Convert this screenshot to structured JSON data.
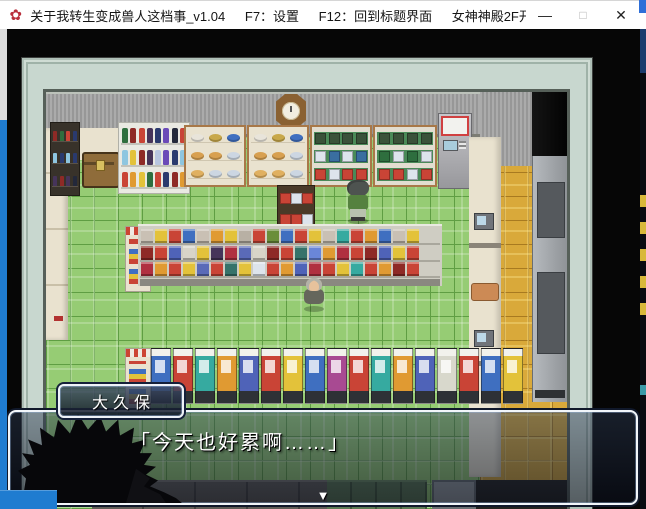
{
  "titlebar": {
    "app_icon": "✿",
    "segments": [
      "关于我转生变成兽人这档事_v1.04",
      "F7：设置",
      "F12：回到标题界面",
      "女神神殿2F开永久..."
    ],
    "controls": {
      "minimize": "—",
      "maximize": "□",
      "close": "✕"
    }
  },
  "dialogue": {
    "speaker": "大久保",
    "text": "「今天也好累啊……」",
    "continue_indicator": "▼"
  },
  "theme": {
    "floor": "#96cc74",
    "floorline": "#5f9e43",
    "corridor": "#d9a93a",
    "corridorline": "#a87a20",
    "wall": "#a2a2a2",
    "frame": "#c8d7cf",
    "cream": "#e9e2cf",
    "wood": "#a87848",
    "taskbar": "#1f7cd0",
    "dialogborder": "#f2f6fa"
  },
  "map": {
    "characters": [
      {
        "name": "clerk",
        "hair": "#4e5350",
        "shirt": "#55813f",
        "pants": "#b9c2ae"
      },
      {
        "name": "elder",
        "head": "#e7c29c",
        "hair": "#b2b2a8",
        "coat": "#65665c"
      }
    ],
    "generated": {
      "vending": {
        "cls": "vm",
        "colors": [
          "#3f6fc0",
          "#c94436",
          "#36aaa0",
          "#e09a32",
          "#4f63b8",
          "#c94436",
          "#e3c23a",
          "#3f6fc0",
          "#a84a92",
          "#c94436",
          "#36aaa0",
          "#e09a32",
          "#4f63b8",
          "#d8d8cc",
          "#c94436",
          "#3f6fc0",
          "#e3c23a"
        ]
      },
      "aisle_top": {
        "cls": "itm",
        "colors": [
          "#c9c0b4",
          "#e3c23a",
          "#c94436",
          "#3f6fc0",
          "#c9c0b4",
          "#e09a32",
          "#e3c23a",
          "#b8b0a4",
          "#c94436",
          "#6a8e3a",
          "#3f6fc0",
          "#c94436",
          "#e3c23a",
          "#c9c0b4",
          "#36aaa0",
          "#c94436",
          "#e09a32",
          "#3f6fc0",
          "#c9c0b4",
          "#e3c23a"
        ]
      },
      "aisle_mid": {
        "cls": "itm",
        "colors": [
          "#8e2a26",
          "#c94436",
          "#4f63b8",
          "#d8d4c8",
          "#e3c23a",
          "#46345a",
          "#b03040",
          "#5a6ab8",
          "#d8d4c8",
          "#8e2a26",
          "#c94436",
          "#36736a",
          "#6a86d8",
          "#e09a32",
          "#b03040",
          "#c94436",
          "#8e2a26",
          "#4f63b8",
          "#e3c23a",
          "#c94436"
        ]
      },
      "aisle_low": {
        "cls": "itm",
        "colors": [
          "#b03040",
          "#e09a32",
          "#c94436",
          "#e3c23a",
          "#5a6ab8",
          "#c94436",
          "#36736a",
          "#e3c23a",
          "#dde4ec",
          "#c94436",
          "#e09a32",
          "#4f63b8",
          "#b03040",
          "#c94436",
          "#e3c23a",
          "#36aaa0",
          "#c94436",
          "#e09a32",
          "#8e2a26",
          "#c94436"
        ]
      },
      "bottles_r1": {
        "cls": "bottle",
        "colors": [
          "#2e6e3e",
          "#8e2a26",
          "#c94436",
          "#46345a",
          "#2a3a6e",
          "#6a4ab8",
          "#23283a",
          "#c94436"
        ]
      },
      "bottles_r2": {
        "cls": "bottle",
        "colors": [
          "#8ec6e0",
          "#e3c23a",
          "#8e2a26",
          "#46345a",
          "#b8c6e0",
          "#6a4ab8",
          "#2a3a6e",
          "#8ec6e0"
        ]
      },
      "bottles_r3": {
        "cls": "bottle",
        "colors": [
          "#c94436",
          "#e09a32",
          "#e3c23a",
          "#2e6e3e",
          "#c94436",
          "#2a3a6e",
          "#8e2a26",
          "#e09a32"
        ]
      },
      "left_r1": {
        "cls": "minib",
        "colors": [
          "#8e2a26",
          "#2e6e3e",
          "#c94436",
          "#2a3a6e"
        ]
      },
      "left_r2": {
        "cls": "minib",
        "colors": [
          "#8ec6e0",
          "#2a3a6e",
          "#8ec6e0",
          "#2a3a6e"
        ]
      },
      "left_r3": {
        "cls": "minib",
        "colors": [
          "#46345a",
          "#8e2a26",
          "#46345a",
          "#23283a"
        ]
      },
      "counterA_r1": {
        "cls": "food",
        "colors": [
          "#e8e4da",
          "#c8a84a",
          "#3f6fc0"
        ]
      },
      "counterA_r2": {
        "cls": "food",
        "colors": [
          "#d8a050",
          "#d8a050",
          "#ccd6e2"
        ]
      },
      "counterA_r3": {
        "cls": "food",
        "colors": [
          "#e0b060",
          "#ccd6e2",
          "#ccd6e2"
        ]
      },
      "counterB_r1": {
        "cls": "food",
        "colors": [
          "#e8e4da",
          "#c8a84a",
          "#3f6fc0"
        ]
      },
      "counterB_r2": {
        "cls": "food",
        "colors": [
          "#d8a050",
          "#d8a050",
          "#ccd6e2"
        ]
      },
      "counterB_r3": {
        "cls": "food",
        "colors": [
          "#e0b060",
          "#e0b060",
          "#ccd6e2"
        ]
      },
      "shelfC_r1": {
        "cls": "pack",
        "colors": [
          "#3a523a",
          "#3a523a",
          "#3a523a",
          "#3a523a"
        ]
      },
      "shelfC_r2": {
        "cls": "pack",
        "colors": [
          "#dde4ec",
          "#3a6ea0",
          "#dde4ec",
          "#3a6ea0"
        ]
      },
      "shelfC_r3": {
        "cls": "pack",
        "colors": [
          "#c94436",
          "#dde4ec",
          "#c94436",
          "#c94436"
        ]
      },
      "shelfD_r1": {
        "cls": "pack",
        "colors": [
          "#3a523a",
          "#3a523a",
          "#3a523a",
          "#3a523a"
        ]
      },
      "shelfD_r2": {
        "cls": "pack",
        "colors": [
          "#2e6e3e",
          "#dde4ec",
          "#2e6e3e",
          "#dde4ec"
        ]
      },
      "shelfD_r3": {
        "cls": "pack",
        "colors": [
          "#c94436",
          "#c94436",
          "#dde4ec",
          "#c94436"
        ]
      },
      "mid_r1": {
        "cls": "pack",
        "colors": [
          "#c94436",
          "#dde4ec",
          "#c94436"
        ]
      },
      "mid_r2": {
        "cls": "pack",
        "colors": [
          "#c94436",
          "#c94436",
          "#dde4ec"
        ]
      }
    }
  }
}
